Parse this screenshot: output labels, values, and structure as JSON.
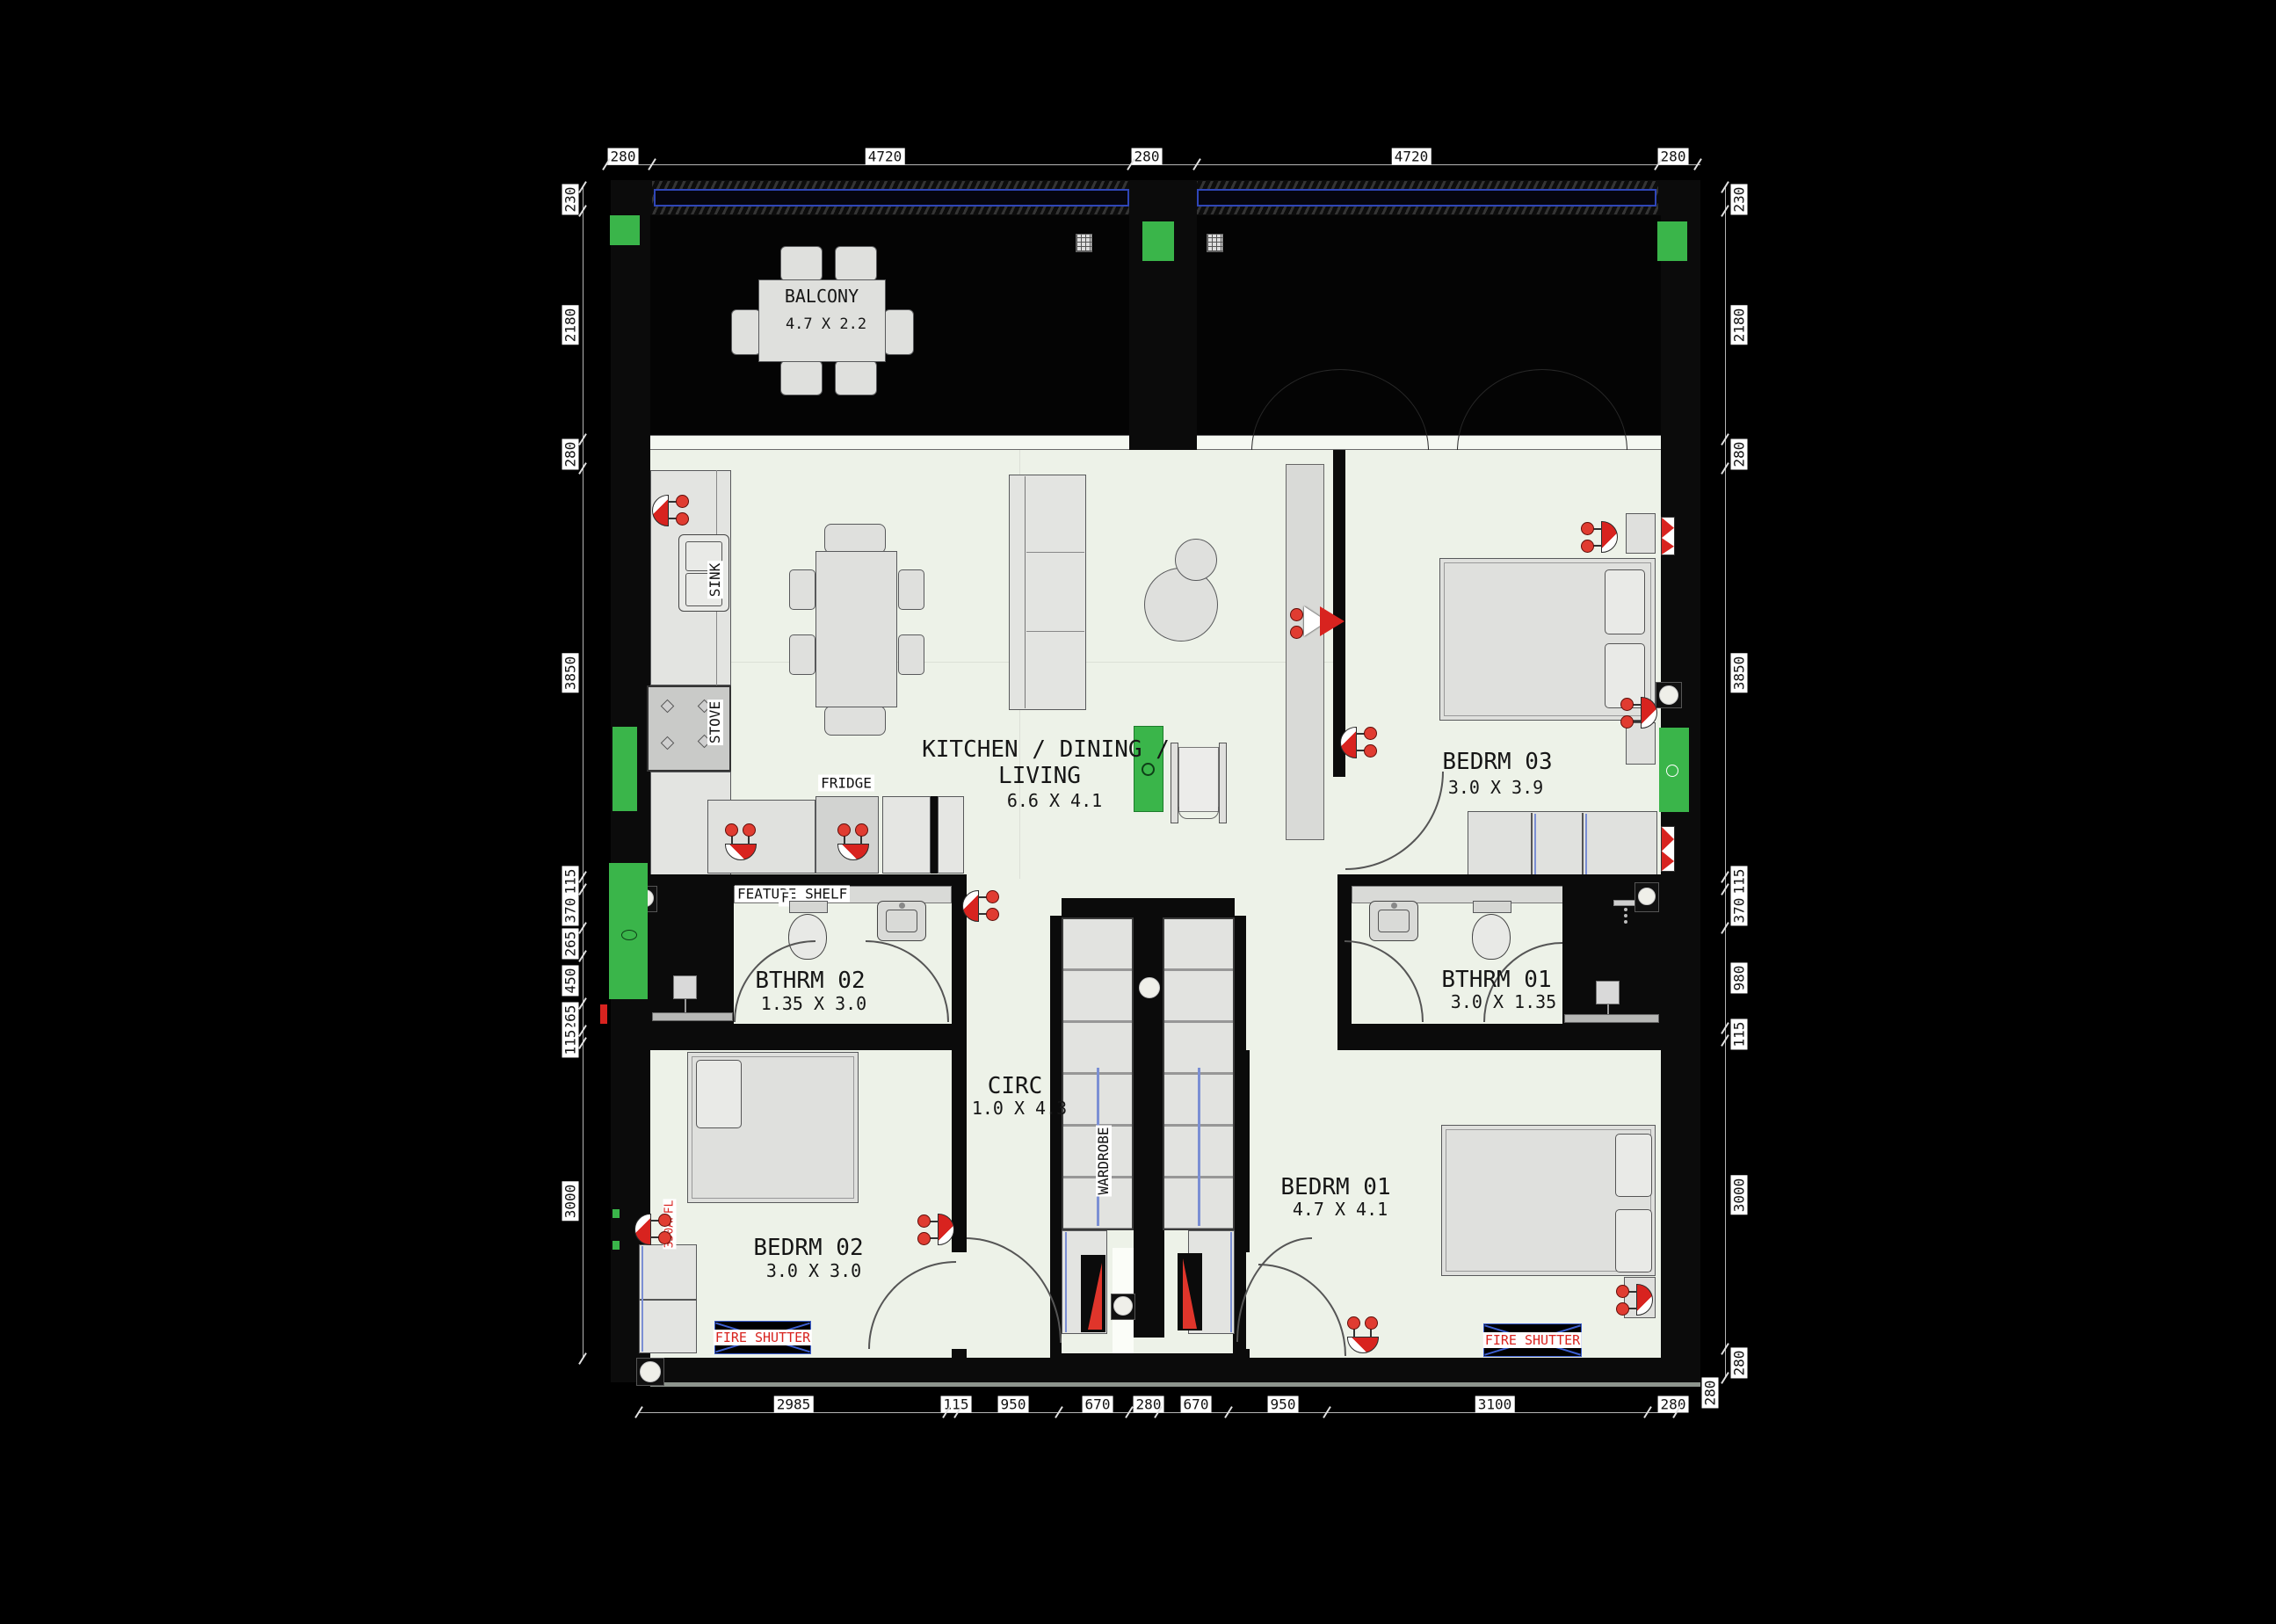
{
  "colors": {
    "accent_green": "#3ab54a",
    "accent_red": "#d8231f",
    "railing_blue": "#2f46b8",
    "shutter_blue": "#3c5fd0",
    "floor": "#edf2e8",
    "wall": "#0b0b0b"
  },
  "rooms": {
    "balcony": {
      "name": "BALCONY",
      "dims": "4.7 X 2.2"
    },
    "living": {
      "name_line1": "KITCHEN / DINING /",
      "name_line2": "LIVING",
      "dims": "6.6 X 4.1"
    },
    "bedrm03": {
      "name": "BEDRM 03",
      "dims": "3.0 X 3.9"
    },
    "bthrm02": {
      "name": "BTHRM 02",
      "dims": "1.35 X 3.0"
    },
    "bthrm01": {
      "name": "BTHRM 01",
      "dims": "3.0 X 1.35"
    },
    "circ": {
      "name": "CIRC",
      "dims": "1.0 X 4.3"
    },
    "bedrm02": {
      "name": "BEDRM 02",
      "dims": "3.0 X 3.0"
    },
    "bedrm01": {
      "name": "BEDRM 01",
      "dims": "4.7 X 4.1"
    }
  },
  "fixtures": {
    "sink": "SINK",
    "stove": "STOVE",
    "fridge": "FRIDGE",
    "wardrobe": "WARDROBE",
    "feature_shelf": "FEATURE SHELF",
    "feature_shelf_marker": "F"
  },
  "safety": {
    "fire_shutter": "FIRE SHUTTER",
    "affl_note": "350AFFL"
  },
  "dimensions": {
    "top": [
      "280",
      "4720",
      "280",
      "4720",
      "280"
    ],
    "left": [
      "230",
      "2180",
      "280",
      "3850",
      "115",
      "370",
      "265",
      "450",
      "265",
      "115",
      "3000"
    ],
    "right": [
      "230",
      "2180",
      "280",
      "3850",
      "115",
      "370",
      "980",
      "115",
      "3000",
      "280"
    ],
    "bottom": [
      "2985",
      "115",
      "950",
      "670",
      "280",
      "670",
      "950",
      "3100",
      "280"
    ],
    "bottom_right_vertical": "280"
  }
}
